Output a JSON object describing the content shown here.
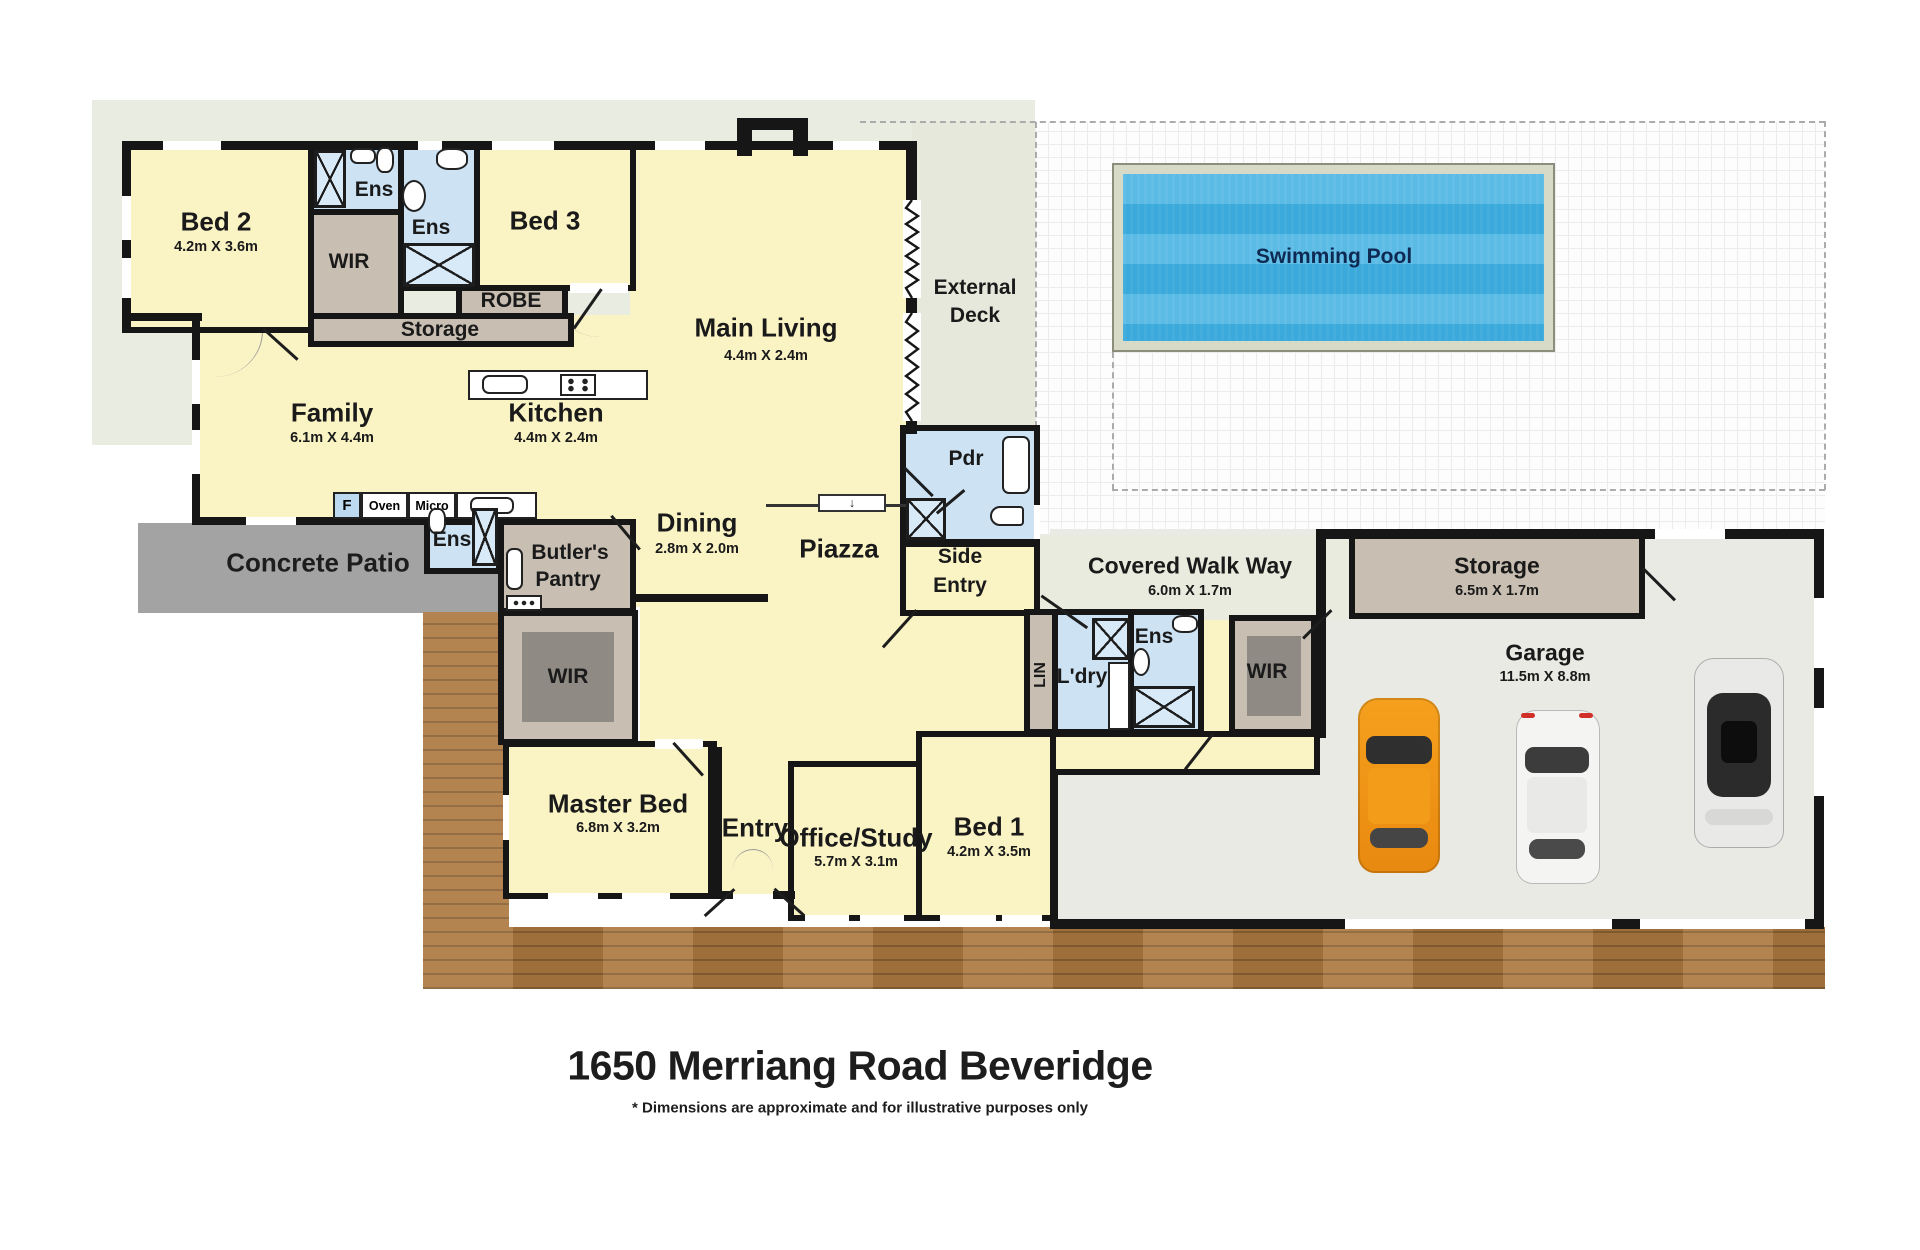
{
  "title": "1650 Merriang Road Beveridge",
  "disclaimer": "* Dimensions are approximate and for illustrative purposes only",
  "icons": {
    "step_down_arrow": "↓"
  },
  "pool": {
    "label": "Swimming Pool"
  },
  "site": {
    "external_deck_line1": "External",
    "external_deck_line2": "Deck",
    "concrete_patio": "Concrete Patio",
    "covered_walkway": {
      "label": "Covered Walk Way",
      "dims": "6.0m X 1.7m"
    }
  },
  "rooms": {
    "bed2": {
      "label": "Bed 2",
      "dims": "4.2m X 3.6m"
    },
    "ens_bed2": {
      "label": "Ens"
    },
    "wir_bed2": {
      "label": "WIR"
    },
    "ens_bed3": {
      "label": "Ens"
    },
    "bed3": {
      "label": "Bed 3"
    },
    "robe": {
      "label": "ROBE"
    },
    "storage_hall": {
      "label": "Storage"
    },
    "main_living": {
      "label": "Main Living",
      "dims": "4.4m X 2.4m"
    },
    "family": {
      "label": "Family",
      "dims": "6.1m X 4.4m"
    },
    "kitchen": {
      "label": "Kitchen",
      "dims": "4.4m X 2.4m"
    },
    "dining": {
      "label": "Dining",
      "dims": "2.8m X 2.0m"
    },
    "piazza": {
      "label": "Piazza"
    },
    "pdr": {
      "label": "Pdr"
    },
    "side_entry": {
      "line1": "Side",
      "line2": "Entry"
    },
    "butlers_pantry": {
      "line1": "Butler's",
      "line2": "Pantry"
    },
    "ens_master": {
      "label": "Ens"
    },
    "wir_master": {
      "label": "WIR"
    },
    "master_bed": {
      "label": "Master Bed",
      "dims": "6.8m X 3.2m"
    },
    "entry": {
      "label": "Entry"
    },
    "lin": {
      "label": "LIN"
    },
    "laundry": {
      "label": "L'dry"
    },
    "ens_bed1": {
      "label": "Ens"
    },
    "wir_bed1": {
      "label": "WIR"
    },
    "bed1": {
      "label": "Bed 1",
      "dims": "4.2m X 3.5m"
    },
    "office_study": {
      "label": "Office/Study",
      "dims": "5.7m X 3.1m"
    },
    "storage_garage": {
      "label": "Storage",
      "dims": "6.5m X 1.7m"
    },
    "garage": {
      "label": "Garage",
      "dims": "11.5m X 8.8m"
    }
  },
  "kitchen_fixtures": {
    "fridge": "F",
    "oven": "Oven",
    "micro": "Micro"
  }
}
